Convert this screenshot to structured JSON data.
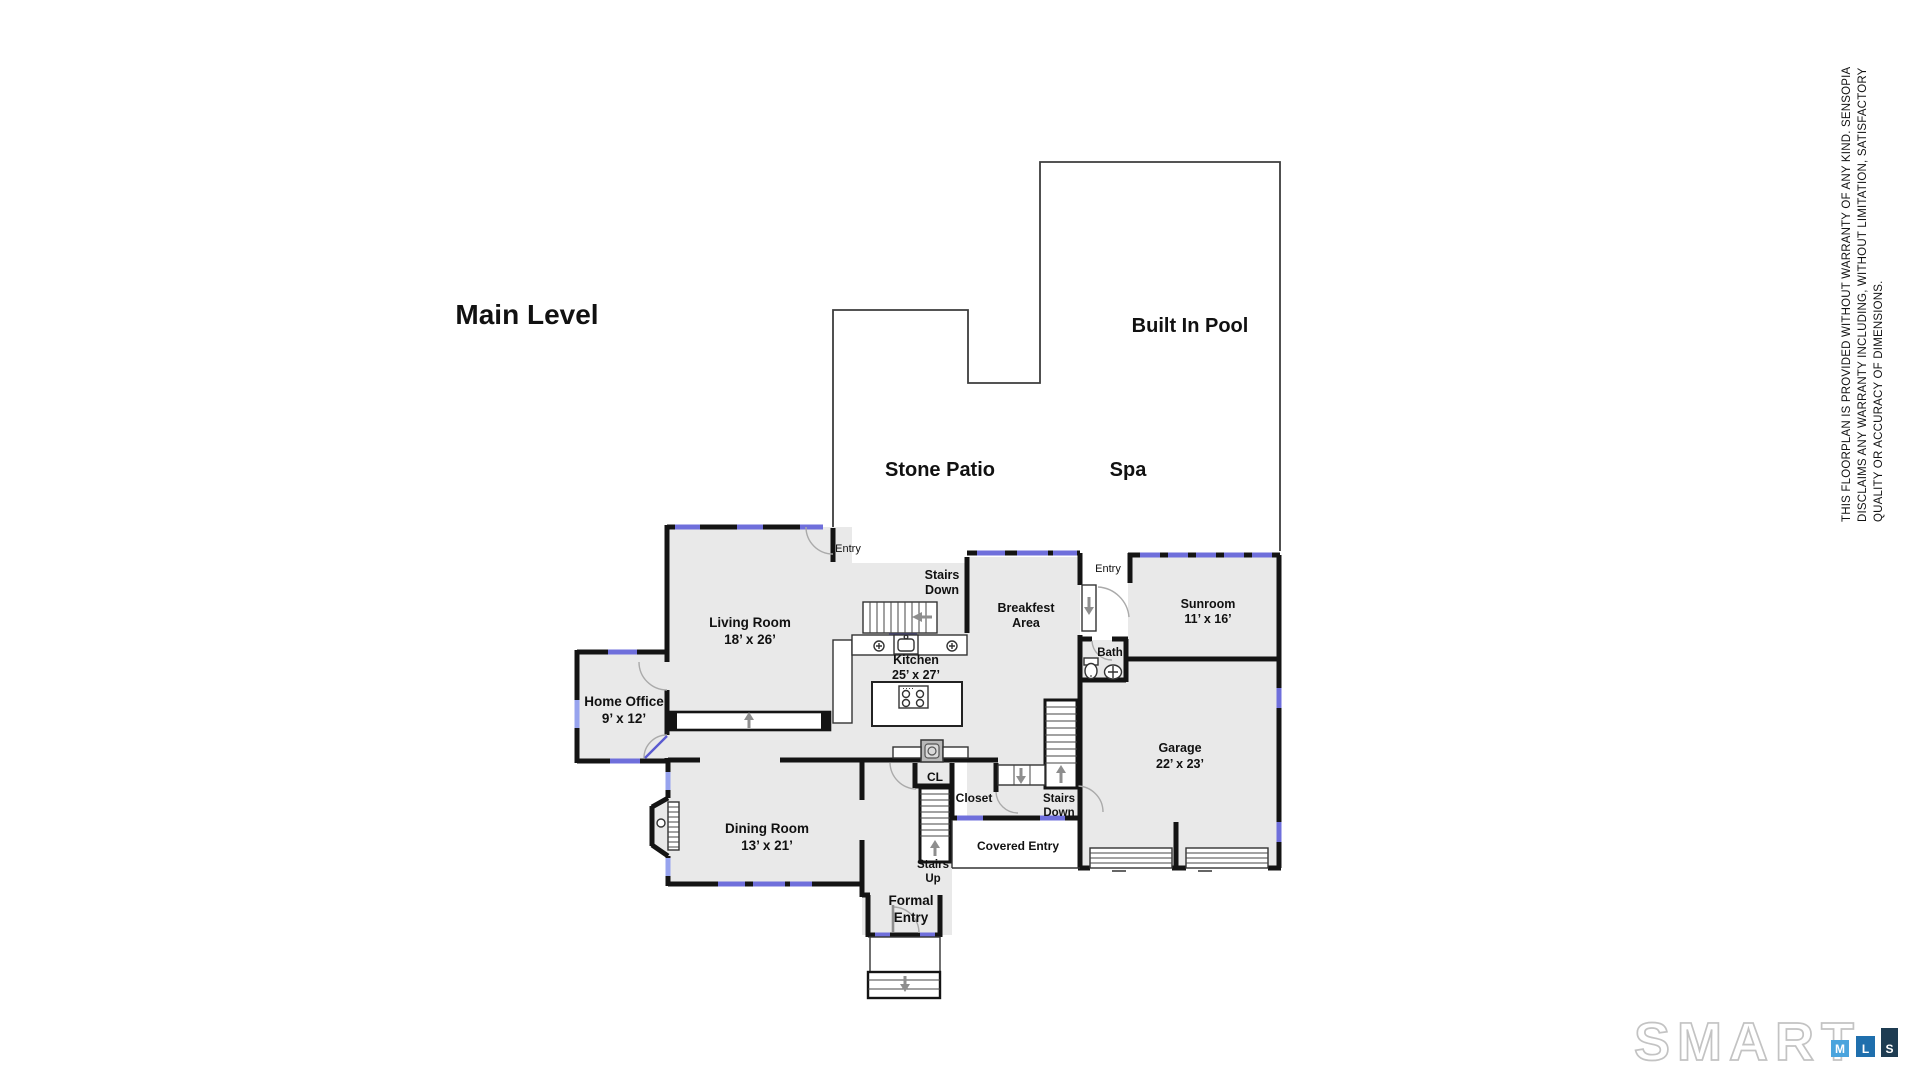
{
  "title": "Main Level",
  "outdoor": {
    "pool": "Built In Pool",
    "patio": "Stone Patio",
    "spa": "Spa"
  },
  "rooms": {
    "living": {
      "line1": "Living Room",
      "line2": "18’ x 26’"
    },
    "home_office": {
      "line1": "Home Office",
      "line2": "9’ x 12’"
    },
    "kitchen": {
      "line1": "Kitchen",
      "line2": "25’ x 27’"
    },
    "breakfast": {
      "line1": "Breakfest",
      "line2": "Area"
    },
    "sunroom": {
      "line1": "Sunroom",
      "line2": "11’ x 16’"
    },
    "bath": {
      "line1": "Bath"
    },
    "garage": {
      "line1": "Garage",
      "line2": "22’ x 23’"
    },
    "dining": {
      "line1": "Dining Room",
      "line2": "13’ x 21’"
    }
  },
  "annotations": {
    "entry_top": "Entry",
    "entry_right": "Entry",
    "stairs_down_kitchen_1": "Stairs",
    "stairs_down_kitchen_2": "Down",
    "stairs_down_hall_1": "Stairs",
    "stairs_down_hall_2": "Down",
    "stairs_up_1": "Stairs",
    "stairs_up_2": "Up",
    "cl": "CL",
    "closet": "Closet",
    "covered_entry": "Covered Entry",
    "formal_entry_1": "Formal",
    "formal_entry_2": "Entry"
  },
  "disclaimer": {
    "line1": "THIS FLOORPLAN IS PROVIDED WITHOUT WARRANTY OF ANY KIND. SENSOPIA",
    "line2": "DISCLAIMS ANY WARRANTY INCLUDING, WITHOUT LIMITATION, SATISFACTORY",
    "line3": "QUALITY OR ACCURACY OF DIMENSIONS."
  },
  "logo": {
    "wordmark": "SMART",
    "m": "M",
    "l": "L",
    "s": "S"
  },
  "colors": {
    "wall": "#141414",
    "floor": "#e9e9e9",
    "window": "#6f6fdb",
    "window_light": "#97a3ee",
    "arrow": "#8e8e8e",
    "logo_m_bg": "#4aa4dd",
    "logo_l_bg": "#1f6fad",
    "logo_s_bg": "#1e3c52",
    "logo_outline": "#c3c3c3"
  }
}
